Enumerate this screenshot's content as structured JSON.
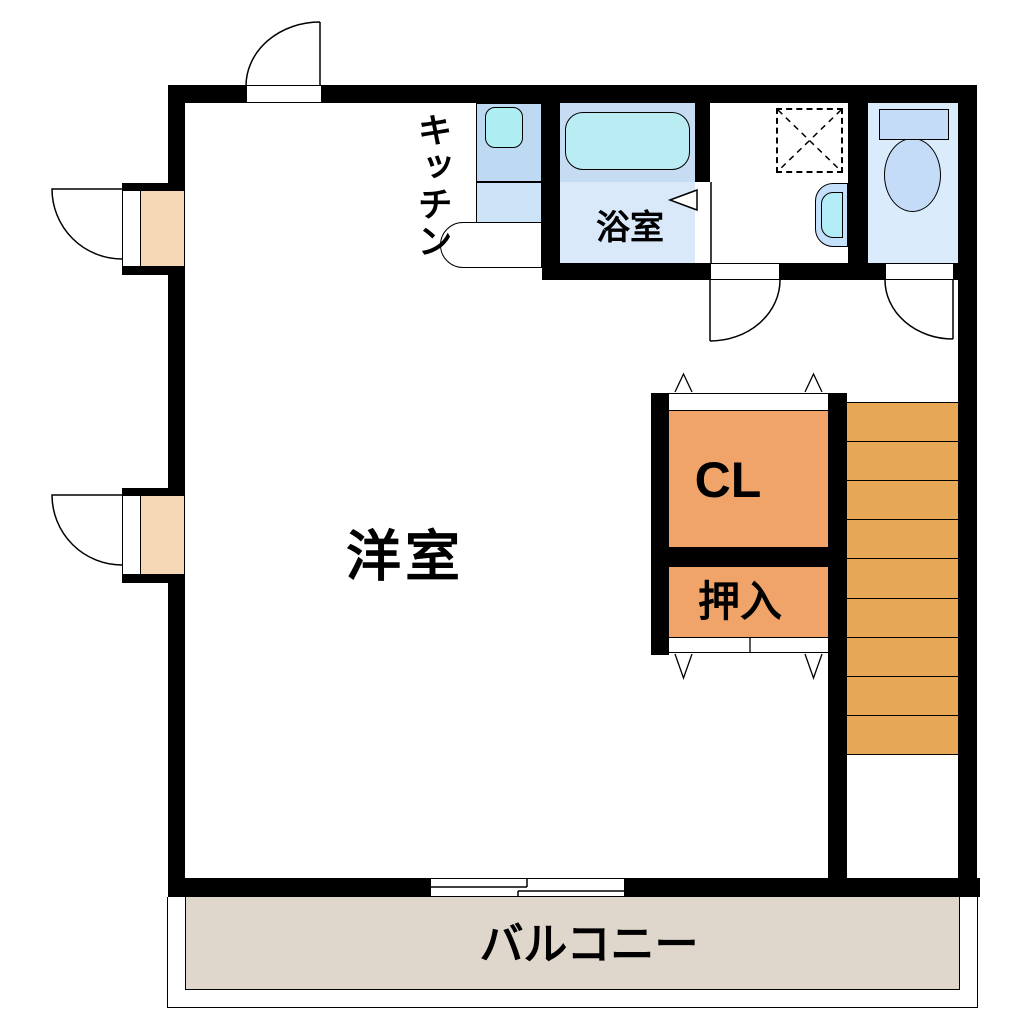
{
  "labels": {
    "main_room": "洋室",
    "kitchen": "キッチン",
    "bath": "浴室",
    "closet": "CL",
    "oshiire": "押入",
    "balcony": "バルコニー"
  },
  "stairs": {
    "steps": 9
  },
  "colors": {
    "wall": "#000000",
    "text": "#000000",
    "closet_fill": "#f0a46a",
    "stairs_fill": "#e6a857",
    "balcony_fill": "#e0d7cc",
    "door_sill": "#f6d7b5",
    "counter_blue": "#bedaf3",
    "counter_blue_light": "#cde4f8",
    "sink_cyan": "#aeeef2",
    "tub_surround": "#c5dcf3",
    "tub_fill": "#baecf4",
    "bath_floor": "#d9e9fa",
    "toilet_floor": "#daebfc",
    "fixture_blue": "#c5dcf8",
    "basin_outer": "#c5e0fa",
    "basin_inner": "#b2ecf6"
  }
}
